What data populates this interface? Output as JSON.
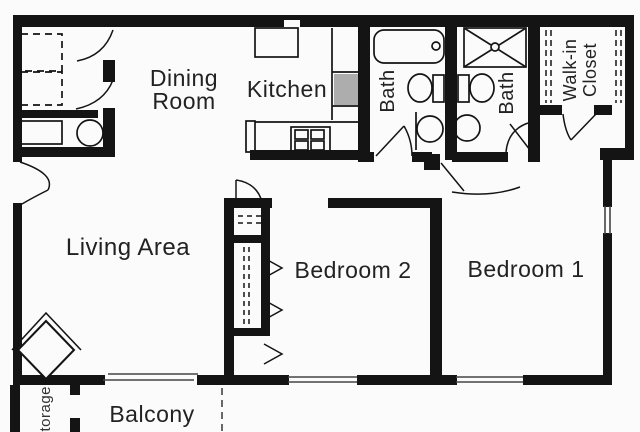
{
  "colors": {
    "background": "#fbfbfb",
    "wall": "#141414",
    "text": "#222222",
    "counter_shade": "#adadad"
  },
  "rooms": {
    "dining": {
      "line1": "Dining",
      "line2": "Room"
    },
    "kitchen": {
      "label": "Kitchen"
    },
    "bath_left": {
      "label": "Bath"
    },
    "bath_right": {
      "label": "Bath"
    },
    "walk_in_closet": {
      "line1": "Walk-in",
      "line2": "Closet"
    },
    "living": {
      "label": "Living Area"
    },
    "bedroom2": {
      "label": "Bedroom 2"
    },
    "bedroom1": {
      "label": "Bedroom 1"
    },
    "balcony": {
      "label": "Balcony"
    },
    "storage": {
      "label": "Storage"
    }
  },
  "fixtures": [
    "washer-dryer-icon",
    "utility-sink-icon",
    "water-heater-icon",
    "refrigerator-icon",
    "kitchen-counter-icon",
    "kitchen-sink-icon",
    "range-icon",
    "bathtub-icon",
    "toilet-icon",
    "sink-icon",
    "shower-icon",
    "closet-shelf-icon",
    "closet-rod-icon",
    "fireplace-icon",
    "door-swing-icon",
    "sliding-glass-door-icon",
    "window-icon"
  ]
}
